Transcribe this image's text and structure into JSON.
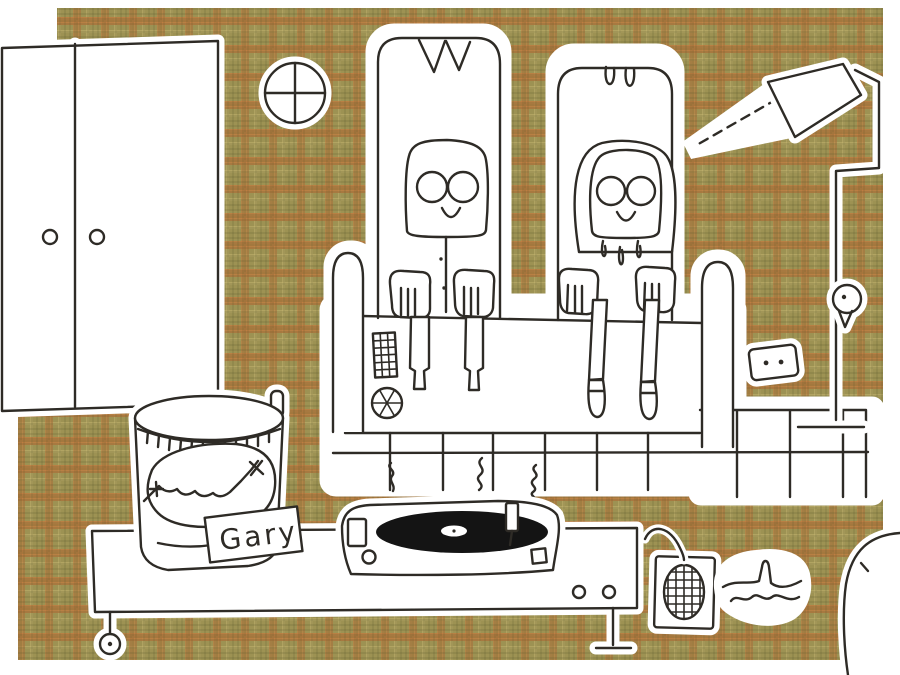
{
  "jar": {
    "label": "Gary"
  },
  "colors": {
    "paper": "#ffffff",
    "ink": "#2e2b26",
    "plaid-base": "#9d9253",
    "plaid-orange": "#c1793f",
    "plaid-dark": "#5f5c2c",
    "plaid-light": "#c6b671",
    "vinyl": "#141414"
  }
}
